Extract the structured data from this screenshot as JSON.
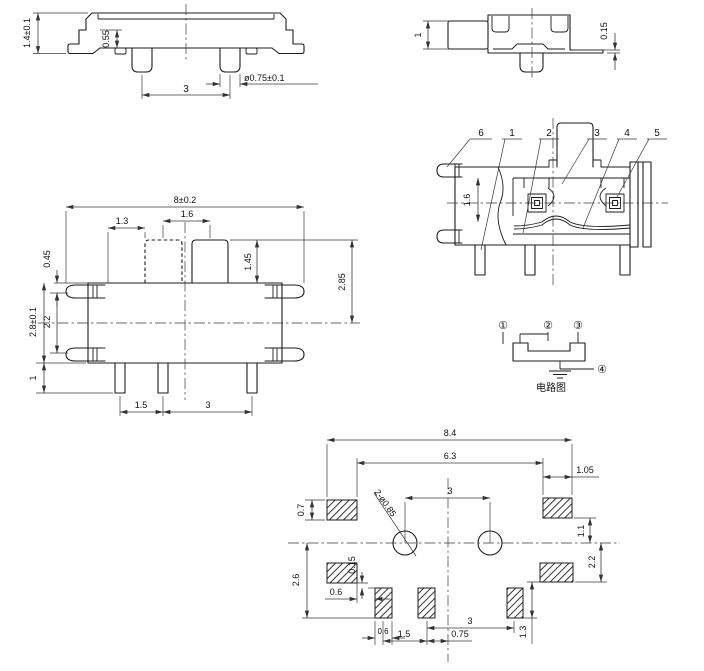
{
  "views": {
    "side_elevation": {
      "dim_height": "1.4±0.1",
      "dim_step": "0.55",
      "dim_pin_pitch": "3",
      "dim_pin_diameter": "ø0.75±0.1"
    },
    "end_view": {
      "dim_knob": "1",
      "dim_tab_thickness": "0.15"
    },
    "top_view": {
      "dim_width": "8±0.2",
      "dim_travel": "1.6",
      "dim_knob_width": "1.3",
      "dim_knob_height": "1.45",
      "dim_knob_to_center": "2.85",
      "dim_tab": "0.45",
      "dim_depth": "2.8±0.1",
      "dim_tab_span": "2.2",
      "dim_pin_length": "1",
      "dim_pin_pitch_1": "1.5",
      "dim_pin_pitch_2": "3"
    },
    "section_view": {
      "labels": [
        "6",
        "1",
        "2",
        "3",
        "4",
        "5"
      ],
      "dim_contact": "1.6"
    },
    "circuit_diagram": {
      "terminal_1": "①",
      "terminal_2": "②",
      "terminal_3": "③",
      "terminal_4": "④",
      "caption": "电路图"
    },
    "footprint": {
      "dim_overall_width": "8.4",
      "dim_inner_width": "6.3",
      "dim_side_pad_width": "1.05",
      "dim_side_pad_height": "0.7",
      "dim_hole_pitch": "3",
      "hole_callout": "2-ø0.85",
      "dim_pad_to_center": "1.1",
      "dim_lower_pad": "2.2",
      "dim_bottom_row": "2.6",
      "dim_pad_gap": "0.15",
      "dim_edge_gap": "0.6",
      "dim_pad_width": "0.6",
      "dim_pitch_1": "1.5",
      "dim_pitch_2": "0.75",
      "dim_pitch_3": "3",
      "dim_pad_height": "1.3"
    }
  }
}
